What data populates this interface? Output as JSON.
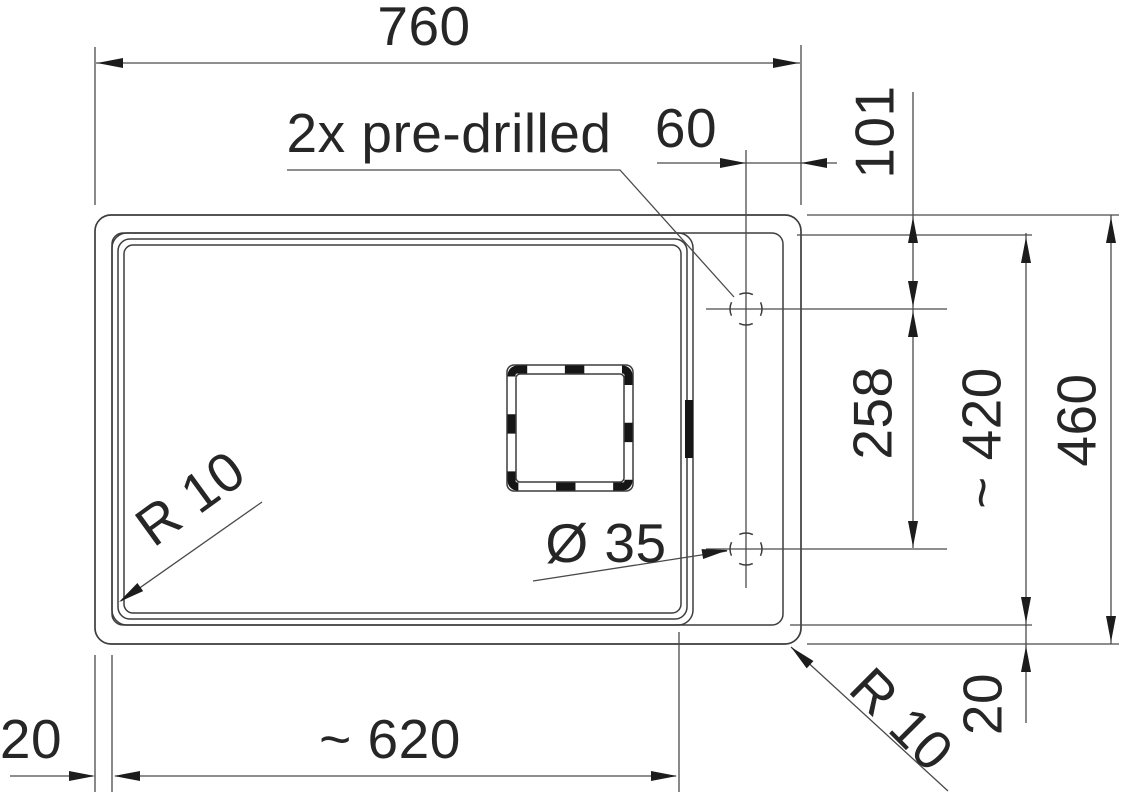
{
  "drawing": {
    "type": "sink installation technical drawing, top view",
    "note": "2x pre-drilled",
    "dims": {
      "total_width": "760",
      "hole_offset_from_right_edge": "60",
      "hole_offset_from_top_edge": "101",
      "hole_spacing": "258",
      "cutout_height": "~ 420",
      "total_height": "460",
      "bowl_width": "~ 620",
      "left_margin": "20",
      "bottom_margin": "20",
      "bowl_corner_radius": "R 10",
      "outer_corner_radius": "R 10",
      "tap_hole_diameter": "Ø 35"
    },
    "colors": {
      "background": "#ffffff",
      "edge_line": "#3d3d3d",
      "dimension_line": "#4a4a4a",
      "arrow": "#1c1c1c",
      "text": "#262626",
      "heavy_dash": "#161616"
    }
  }
}
